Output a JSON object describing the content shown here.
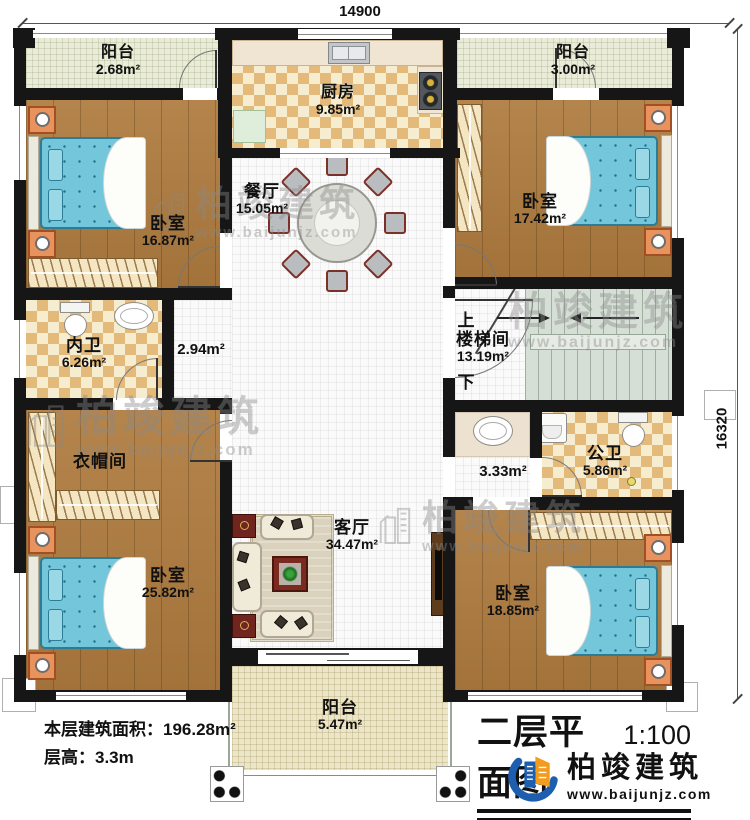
{
  "dimensions": {
    "width": "14900",
    "height": "16320"
  },
  "rooms": {
    "balcony_tl": {
      "name": "阳台",
      "area": "2.68m²"
    },
    "kitchen": {
      "name": "厨房",
      "area": "9.85m²"
    },
    "balcony_tr": {
      "name": "阳台",
      "area": "3.00m²"
    },
    "bedroom_tl": {
      "name": "卧室",
      "area": "16.87m²"
    },
    "dining": {
      "name": "餐厅",
      "area": "15.05m²"
    },
    "bedroom_tr": {
      "name": "卧室",
      "area": "17.42m²"
    },
    "bath_inner": {
      "name": "内卫",
      "area": "6.26m²"
    },
    "hall_left": {
      "area": "2.94m²"
    },
    "stairwell": {
      "name": "楼梯间",
      "area": "13.19m²",
      "up": "上",
      "down": "下"
    },
    "cloakroom": {
      "name": "衣帽间"
    },
    "hall_right": {
      "area": "3.33m²"
    },
    "bath_public": {
      "name": "公卫",
      "area": "5.86m²"
    },
    "living": {
      "name": "客厅",
      "area": "34.47m²"
    },
    "bedroom_bl": {
      "name": "卧室",
      "area": "25.82m²"
    },
    "bedroom_br": {
      "name": "卧室",
      "area": "18.85m²"
    },
    "balcony_b": {
      "name": "阳台",
      "area": "5.47m²"
    }
  },
  "info": {
    "line1": "本层建筑面积：196.28m²",
    "line2": "层高：3.3m"
  },
  "title": {
    "text": "二层平面图",
    "scale": "1:100"
  },
  "brand": {
    "name": "柏竣建筑",
    "url": "www.baijunjz.com"
  },
  "watermark": {
    "name": "柏竣建筑",
    "url": "www.baijunjz.com"
  },
  "colors": {
    "wall": "#161616",
    "wood": "#ae7b3e",
    "tile": "#e4ba7a",
    "stair": "#d6dfd5",
    "bed": "#74c6da",
    "logo_blue": "#1d5fae",
    "logo_orange": "#f29b1d"
  }
}
